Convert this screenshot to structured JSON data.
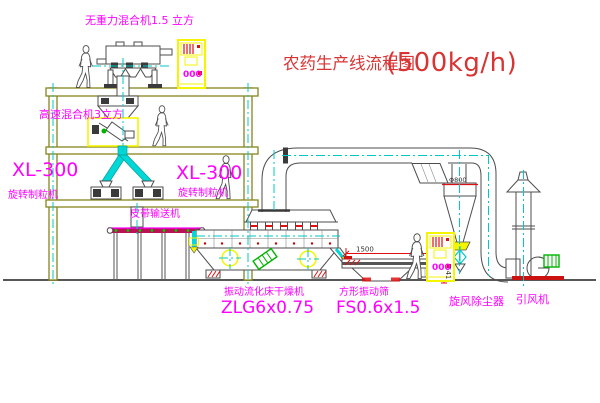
{
  "title": {
    "text": "农药生产线流程图",
    "capacity": "(500kg/h)"
  },
  "labels": {
    "top_mixer": "无重力混合机1.5 立方",
    "high_speed_mixer": "高速混合机3立方",
    "granulator_left_model": "XL-300",
    "granulator_left_name": "旋转制粒机",
    "granulator_mid_model": "XL-300",
    "granulator_mid_name": "旋转制粒机",
    "belt_conveyor": "皮带输送机",
    "dryer_name": "振动流化床干燥机",
    "dryer_model": "ZLG6x0.75",
    "sieve_name": "方形振动筛",
    "sieve_model": "FS0.6x1.5",
    "cyclone_name": "旋风除尘器",
    "fan_name": "引风机"
  },
  "dimensions": {
    "sieve_length": "1500",
    "sieve_height": "541",
    "cyclone_diameter": "Φ800"
  },
  "cabinet": {
    "display": "000"
  },
  "colors": {
    "background": "#ffffff",
    "structure": "#85851c",
    "machine_line": "#4d4d4d",
    "centerline_cyan": "#00c8c8",
    "chute_fill": "#00d8d8",
    "label_magenta": "#ff00ff",
    "title_red": "#d83434",
    "accent_red": "#dd1111",
    "cabinet_yellow": "#f5f500",
    "motor_green": "#00b400"
  }
}
